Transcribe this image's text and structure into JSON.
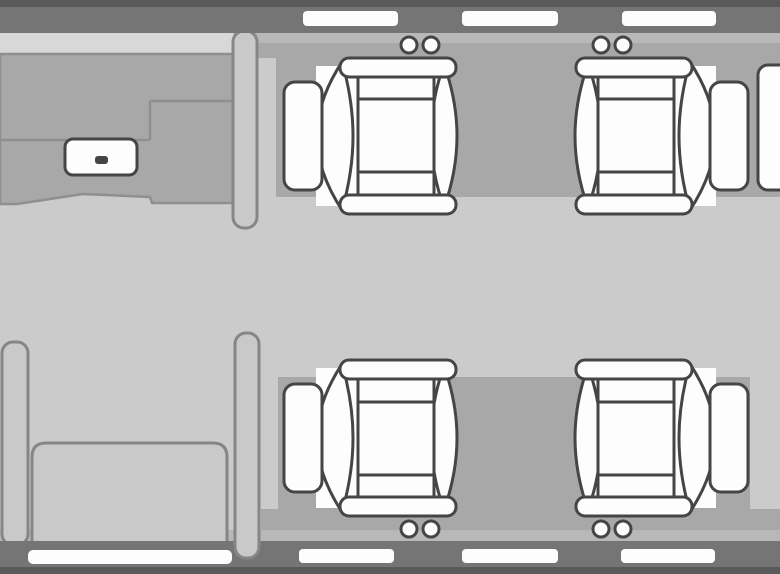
{
  "meta": {
    "title": "aircraft-cabin-floorplan",
    "canvas": {
      "w": 780,
      "h": 574
    }
  },
  "colors": {
    "floor": "#cbcbcb",
    "band": "#a8a8a8",
    "wall": "#757575",
    "wall_edge": "#5a5a5a",
    "wall_inner_line": "#b8b8b8",
    "galley_top": "#d8d8d8",
    "galley_line": "#8f8f8f",
    "furniture_fill": "#c9c9c9",
    "furniture_stroke": "#868686",
    "seat_fill": "#fdfdfd",
    "seat_stroke": "#454545",
    "window_fill": "#fdfdfd"
  },
  "scene": [
    {
      "name": "cabin-floor",
      "type": "rect",
      "attrs": {
        "x": 0,
        "y": 0,
        "width": 780,
        "height": 574,
        "fill": "$floor"
      }
    },
    {
      "name": "top-wall-inner-line",
      "type": "rect",
      "attrs": {
        "x": 0,
        "y": 33,
        "width": 780,
        "height": 10,
        "fill": "$wall_inner_line"
      }
    },
    {
      "name": "top-sidewall-band",
      "type": "rect",
      "attrs": {
        "x": 276,
        "y": 43,
        "width": 504,
        "height": 154,
        "fill": "$band"
      }
    },
    {
      "name": "top-sidewall-step",
      "type": "rect",
      "attrs": {
        "x": 257,
        "y": 43,
        "width": 523,
        "height": 15,
        "fill": "$band"
      }
    },
    {
      "name": "bottom-sidewall-band",
      "type": "rect",
      "attrs": {
        "x": 278,
        "y": 377,
        "width": 472,
        "height": 153,
        "fill": "$band"
      }
    },
    {
      "name": "bottom-sidewall-step",
      "type": "rect",
      "attrs": {
        "x": 261,
        "y": 509,
        "width": 519,
        "height": 32,
        "fill": "$band"
      }
    },
    {
      "name": "bottom-wall-inner-line",
      "type": "rect",
      "attrs": {
        "x": 0,
        "y": 530,
        "width": 780,
        "height": 11,
        "fill": "$wall_inner_line"
      }
    },
    {
      "name": "galley-wall-ledge",
      "type": "rect",
      "attrs": {
        "x": 0,
        "y": 33,
        "width": 233,
        "height": 21,
        "fill": "$galley_top"
      }
    },
    {
      "name": "galley-counter",
      "type": "path",
      "attrs": {
        "d": "M0,54 H233 V203 H152 L150,197 L83,194 L17,204 L0,204 Z",
        "fill": "$band",
        "stroke": "$galley_line",
        "stroke-width": 2.5
      }
    },
    {
      "name": "galley-counter-edges",
      "type": "path",
      "attrs": {
        "d": "M150,101 H233 M150,101 V140 M0,140 H150",
        "fill": "none",
        "stroke": "$galley_line",
        "stroke-width": 2.5
      }
    },
    {
      "name": "galley-sink",
      "type": "rect",
      "attrs": {
        "x": 65,
        "y": 139,
        "width": 72,
        "height": 36,
        "rx": 8,
        "fill": "$seat_fill",
        "stroke": "$seat_stroke",
        "stroke-width": 3
      }
    },
    {
      "name": "galley-sink-drain",
      "type": "rect",
      "attrs": {
        "x": 95,
        "y": 156,
        "width": 13,
        "height": 8,
        "rx": 3,
        "fill": "$seat_stroke"
      }
    },
    {
      "name": "forward-partition",
      "type": "rect",
      "attrs": {
        "x": 233,
        "y": 31,
        "width": 24,
        "height": 197,
        "rx": 11,
        "fill": "$furniture_fill",
        "stroke": "$furniture_stroke",
        "stroke-width": 3
      }
    },
    {
      "name": "side-console",
      "type": "rect",
      "attrs": {
        "x": 2,
        "y": 342,
        "width": 26,
        "height": 203,
        "rx": 11,
        "fill": "$furniture_fill",
        "stroke": "$furniture_stroke",
        "stroke-width": 3
      }
    },
    {
      "name": "bench-seat",
      "type": "path",
      "attrs": {
        "d": "M32,457 Q32,443 46,443 H213 Q227,443 227,457 V545 H32 Z",
        "fill": "$furniture_fill",
        "stroke": "$furniture_stroke",
        "stroke-width": 3
      }
    },
    {
      "name": "top-wall",
      "type": "rect",
      "attrs": {
        "x": 0,
        "y": 7,
        "width": 780,
        "height": 26,
        "fill": "$wall"
      }
    },
    {
      "name": "top-wall-edge",
      "type": "rect",
      "attrs": {
        "x": 0,
        "y": 0,
        "width": 780,
        "height": 7,
        "fill": "$wall_edge"
      }
    },
    {
      "name": "bottom-wall",
      "type": "rect",
      "attrs": {
        "x": 0,
        "y": 541,
        "width": 780,
        "height": 26,
        "fill": "$wall"
      }
    },
    {
      "name": "bottom-wall-edge",
      "type": "rect",
      "attrs": {
        "x": 0,
        "y": 567,
        "width": 780,
        "height": 7,
        "fill": "$wall_edge"
      }
    },
    {
      "name": "aft-partition",
      "type": "rect",
      "attrs": {
        "x": 235,
        "y": 333,
        "width": 24,
        "height": 225,
        "rx": 11,
        "fill": "$furniture_fill",
        "stroke": "$furniture_stroke",
        "stroke-width": 3
      }
    },
    {
      "name": "window-top-1",
      "type": "rect",
      "attrs": {
        "x": 303,
        "y": 11,
        "width": 95,
        "height": 15,
        "rx": 4,
        "fill": "$window_fill"
      }
    },
    {
      "name": "window-top-2",
      "type": "rect",
      "attrs": {
        "x": 462,
        "y": 11,
        "width": 96,
        "height": 15,
        "rx": 4,
        "fill": "$window_fill"
      }
    },
    {
      "name": "window-top-3",
      "type": "rect",
      "attrs": {
        "x": 622,
        "y": 11,
        "width": 94,
        "height": 15,
        "rx": 4,
        "fill": "$window_fill"
      }
    },
    {
      "name": "entry-door",
      "type": "rect",
      "attrs": {
        "x": 28,
        "y": 550,
        "width": 204,
        "height": 14,
        "rx": 5,
        "fill": "$window_fill"
      }
    },
    {
      "name": "window-bottom-1",
      "type": "rect",
      "attrs": {
        "x": 299,
        "y": 549,
        "width": 95,
        "height": 14,
        "rx": 4,
        "fill": "$window_fill"
      }
    },
    {
      "name": "window-bottom-2",
      "type": "rect",
      "attrs": {
        "x": 462,
        "y": 549,
        "width": 96,
        "height": 14,
        "rx": 4,
        "fill": "$window_fill"
      }
    },
    {
      "name": "window-bottom-3",
      "type": "rect",
      "attrs": {
        "x": 621,
        "y": 549,
        "width": 94,
        "height": 14,
        "rx": 4,
        "fill": "$window_fill"
      }
    },
    {
      "name": "partial-cabinet-right-edge",
      "type": "rect",
      "attrs": {
        "x": 758,
        "y": 65,
        "width": 34,
        "height": 125,
        "rx": 10,
        "fill": "$seat_fill",
        "stroke": "$seat_stroke",
        "stroke-width": 3
      }
    }
  ],
  "seat_template": [
    {
      "name": "seat-base",
      "type": "rect",
      "attrs": {
        "x": 20,
        "y": 8,
        "width": 122,
        "height": 140,
        "fill": "$seat_fill",
        "stroke": "none"
      }
    },
    {
      "name": "seat-backrest",
      "type": "path",
      "attrs": {
        "d": "M14,6 Q1,43 1,78 Q1,113 14,150 Q27,113 27,78 Q27,43 14,6 Z",
        "fill": "$seat_fill",
        "stroke": "$seat_stroke",
        "stroke-width": 3
      }
    },
    {
      "name": "seat-front-bolster",
      "type": "path",
      "attrs": {
        "d": "M116,4 Q141,42 141,78 Q141,114 116,152 Q105,114 105,78 Q105,42 116,4 Z",
        "fill": "$seat_fill",
        "stroke": "$seat_stroke",
        "stroke-width": 3
      }
    },
    {
      "name": "seat-footrest",
      "type": "rect",
      "attrs": {
        "x": 136,
        "y": 24,
        "width": 38,
        "height": 108,
        "rx": 11,
        "fill": "$seat_fill",
        "stroke": "$seat_stroke",
        "stroke-width": 3
      }
    },
    {
      "name": "seat-armrest-top",
      "type": "rect",
      "attrs": {
        "x": 2,
        "y": 0,
        "width": 116,
        "height": 19,
        "rx": 9,
        "fill": "$seat_fill",
        "stroke": "$seat_stroke",
        "stroke-width": 3
      }
    },
    {
      "name": "seat-armrest-bottom",
      "type": "rect",
      "attrs": {
        "x": 2,
        "y": 137,
        "width": 116,
        "height": 19,
        "rx": 9,
        "fill": "$seat_fill",
        "stroke": "$seat_stroke",
        "stroke-width": 3
      }
    },
    {
      "name": "seat-cushion",
      "type": "rect",
      "attrs": {
        "x": 24,
        "y": 19,
        "width": 76,
        "height": 118,
        "fill": "$seat_fill",
        "stroke": "$seat_stroke",
        "stroke-width": 3
      }
    },
    {
      "name": "seat-cushion-pleats",
      "type": "path",
      "attrs": {
        "d": "M24,41 H100 M24,114 H100",
        "fill": "none",
        "stroke": "$seat_stroke",
        "stroke-width": 3
      }
    },
    {
      "name": "headrest-knob-left",
      "type": "circle",
      "attrs": {
        "cx": 27,
        "cy": -13,
        "r": 8,
        "fill": "$seat_fill",
        "stroke": "$seat_stroke",
        "stroke-width": 3
      }
    },
    {
      "name": "headrest-knob-right",
      "type": "circle",
      "attrs": {
        "cx": 49,
        "cy": -13,
        "r": 8,
        "fill": "$seat_fill",
        "stroke": "$seat_stroke",
        "stroke-width": 3
      }
    }
  ],
  "seats": [
    {
      "name": "seat-top-left",
      "facing": "forward",
      "transform": "translate(458,58) scale(-1,1)"
    },
    {
      "name": "seat-top-right",
      "facing": "aft",
      "transform": "translate(574,58)"
    },
    {
      "name": "seat-bottom-left",
      "facing": "forward",
      "transform": "translate(458,516) scale(-1,-1)"
    },
    {
      "name": "seat-bottom-right",
      "facing": "aft",
      "transform": "translate(574,516) scale(1,-1)"
    }
  ]
}
